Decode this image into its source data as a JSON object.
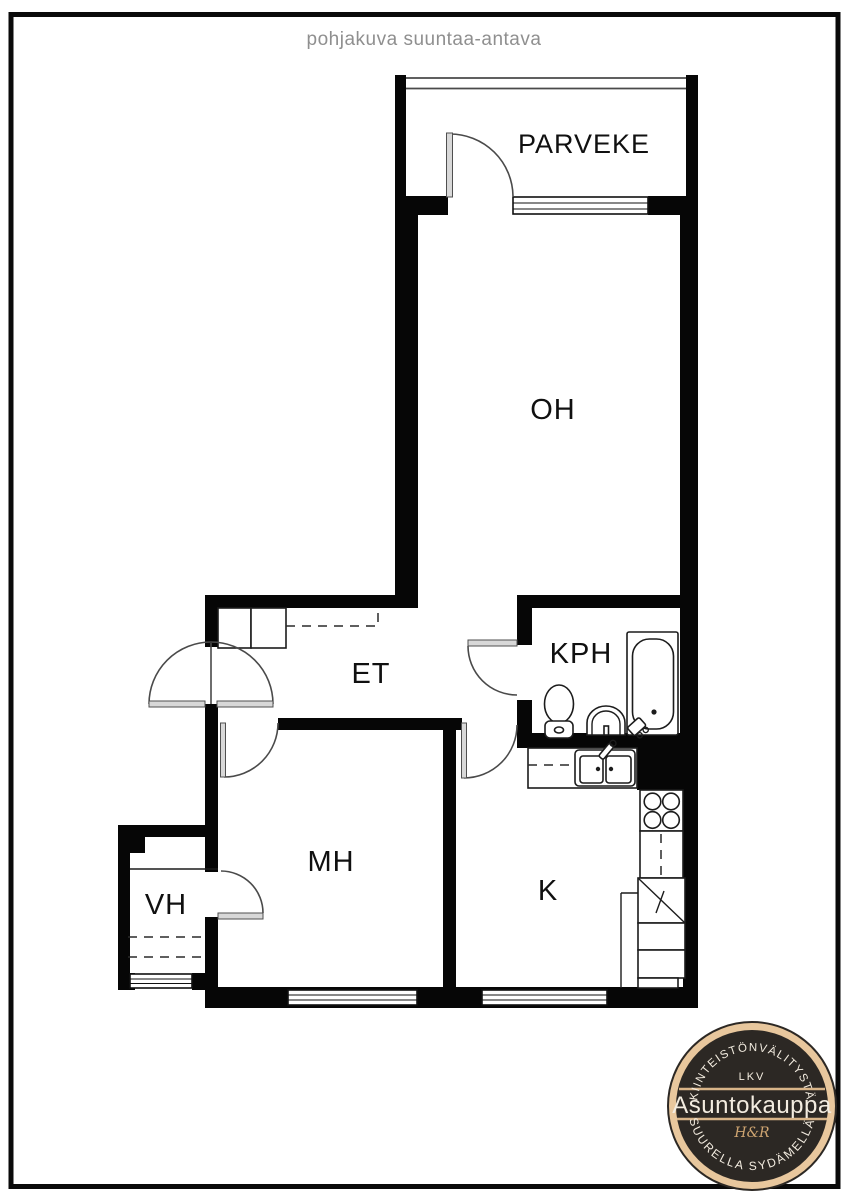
{
  "title": "pohjakuva suuntaa-antava",
  "rooms": {
    "parveke": "PARVEKE",
    "oh": "OH",
    "kph": "KPH",
    "et": "ET",
    "mh": "MH",
    "vh": "VH",
    "k": "K"
  },
  "logo": {
    "top_text": "KIINTEISTÖNVÄLITYSTÄ",
    "lkv": "LKV",
    "name": "Asuntokauppa",
    "monogram": "H&R",
    "bottom_text": "SUURELLA SYDÄMELLÄ",
    "ring_color": "#e8c79d",
    "bg_color": "#2c2824",
    "text_color": "#f3ece0",
    "accent_color": "#d8b488"
  },
  "colors": {
    "wall": "#060606",
    "title_text": "#8f8f8f",
    "label_text": "#101010"
  }
}
